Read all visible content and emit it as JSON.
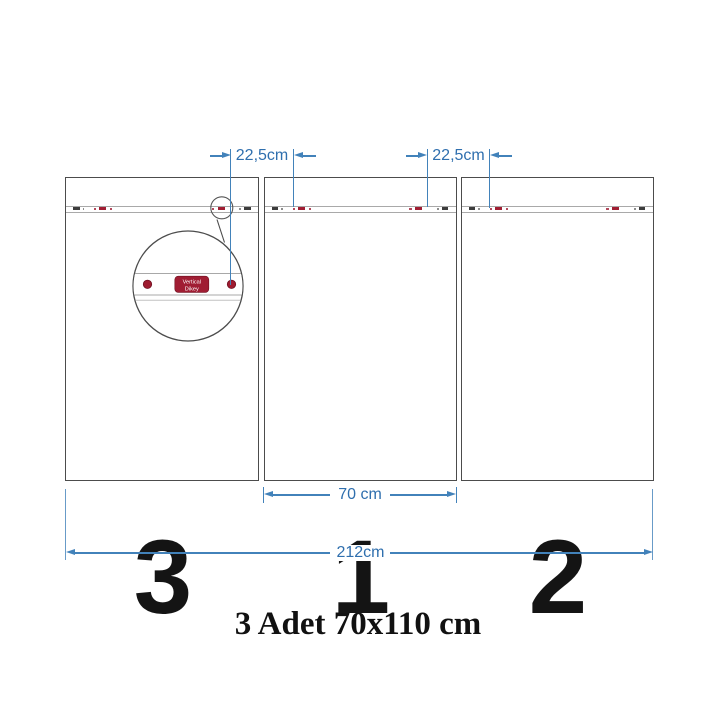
{
  "caption": "3 Adet 70x110 cm",
  "dimensions": {
    "hanger_gap_left": "22,5cm",
    "hanger_gap_right": "22,5cm",
    "panel_width": "70 cm",
    "total_width": "212cm"
  },
  "panels": [
    {
      "number": "3"
    },
    {
      "number": "1"
    },
    {
      "number": "2"
    }
  ],
  "magnifier_badge": {
    "line1": "Vertical",
    "line2": "Dikey"
  },
  "colors": {
    "dimension_blue_line": "#4282ba",
    "dimension_blue_text": "#2f6fae",
    "rail_red": "#a01d32",
    "rail_black": "#3c3c3c",
    "panel_border": "#4c4c4c",
    "badge_red": "#a01d33"
  }
}
